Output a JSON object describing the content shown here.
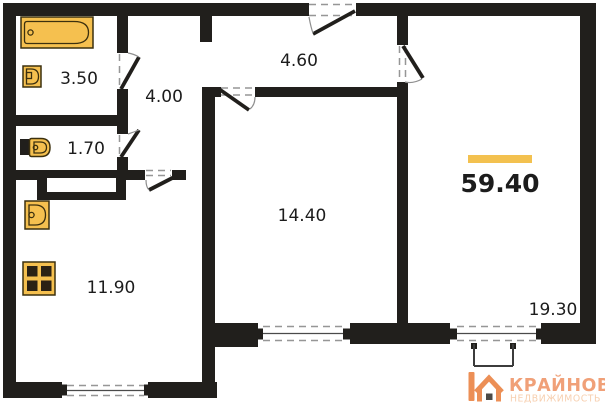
{
  "floorplan": {
    "total_area": "59.40",
    "rooms": {
      "bathroom": "3.50",
      "hallway": "4.00",
      "corridor": "4.60",
      "toilet": "1.70",
      "room": "14.40",
      "kitchen": "11.90",
      "living_room": "19.30"
    },
    "fixtures": [
      "bathtub-icon",
      "sink-icon",
      "toilet-icon",
      "kitchen-sink-icon",
      "stove-icon"
    ],
    "colors": {
      "wall": "#211f1c",
      "fixture": "#f5c04f",
      "fixture_stroke": "#3c300e",
      "burner": "#2a2114",
      "accent": "#f3c14f",
      "ink": "#1c1c1c",
      "dash": "#969696",
      "logo_icon": "#ec8f56",
      "logo_brand": "#f0a078",
      "logo_tagline": "#f7cfaf"
    }
  },
  "logo": {
    "brand": "КРАЙНОВ",
    "tagline": "НЕДВИЖИМОСТЬ"
  }
}
